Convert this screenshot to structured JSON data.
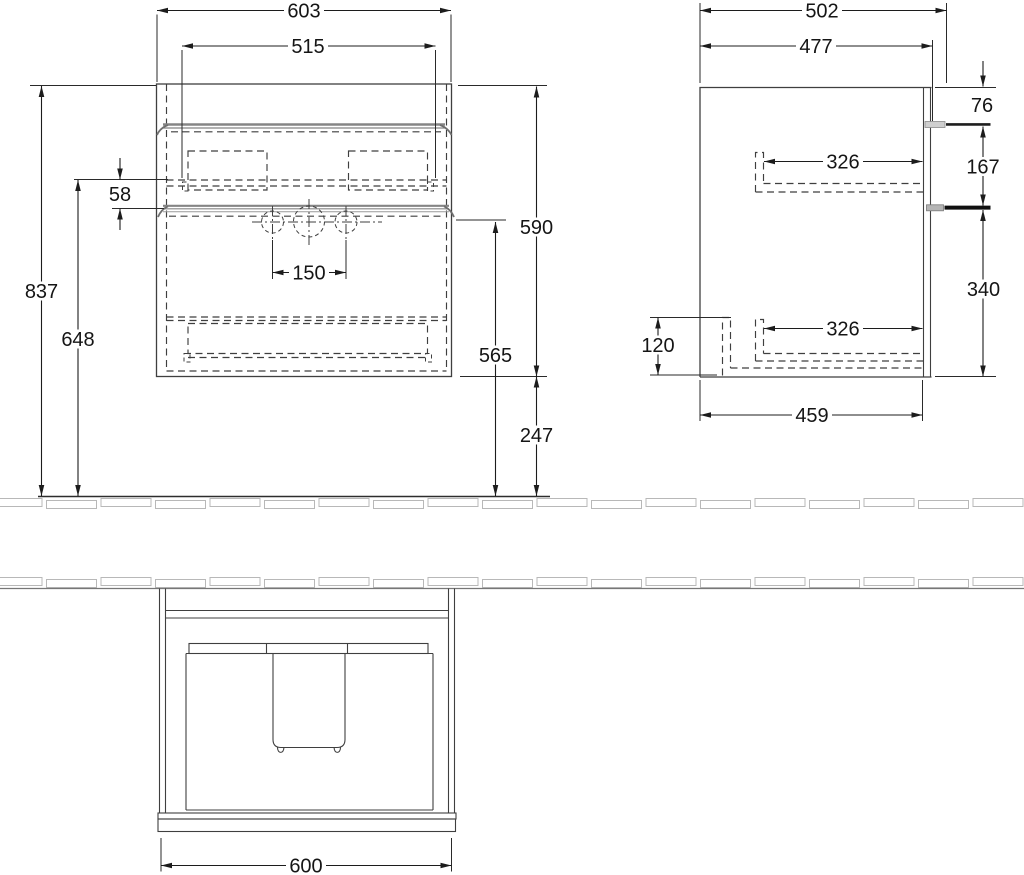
{
  "drawing": {
    "type": "technical-dimension-drawing",
    "subject": "wall-hung bathroom vanity unit: front elevation, side section and plan view",
    "units": "mm",
    "colors": {
      "background": "#ffffff",
      "structure_line": "#3f3f3f",
      "dimension_line": "#1c1c1c",
      "basin_gray": "#858585",
      "hatch_brick": "#b8b8b8",
      "bold_rail": "#101010"
    },
    "views": {
      "front_elevation": {
        "name": "front-elevation",
        "dimensions": [
          {
            "label": "603",
            "labelX": 304,
            "labelY": 10.5,
            "lines": [
              [
                157,
                10.5,
                451,
                10.5
              ]
            ],
            "arrows": [
              {
                "x": 157,
                "y": 10.5,
                "d": "l"
              },
              {
                "x": 451,
                "y": 10.5,
                "d": "r"
              }
            ],
            "exts": [
              [
                157,
                14.5,
                157,
                82
              ],
              [
                451,
                14.5,
                451,
                82
              ]
            ]
          },
          {
            "label": "515",
            "labelX": 308,
            "labelY": 46,
            "lines": [
              [
                182,
                46,
                435.5,
                46
              ]
            ],
            "arrows": [
              {
                "x": 182,
                "y": 46,
                "d": "l"
              },
              {
                "x": 435.5,
                "y": 46,
                "d": "r"
              }
            ],
            "exts": [
              [
                182,
                50,
                182,
                178
              ],
              [
                435.5,
                50,
                435.5,
                178
              ]
            ]
          },
          {
            "label": "58",
            "labelX": 120,
            "labelY": 194,
            "lines": [
              [
                120,
                158,
                120,
                179.5
              ],
              [
                120,
                230,
                120,
                208.5
              ]
            ],
            "arrows": [
              {
                "x": 120,
                "y": 179.5,
                "d": "d"
              },
              {
                "x": 120,
                "y": 208.5,
                "d": "u"
              }
            ],
            "exts": [
              [
                74,
                179.5,
                168,
                179.5
              ],
              [
                112,
                208.5,
                164,
                208.5
              ]
            ]
          },
          {
            "label": "837",
            "labelX": 41.5,
            "labelY": 291,
            "lines": [
              [
                41.5,
                86,
                41.5,
                496
              ]
            ],
            "arrows": [
              {
                "x": 41.5,
                "y": 86,
                "d": "u"
              },
              {
                "x": 41.5,
                "y": 496,
                "d": "d"
              }
            ],
            "exts": [
              [
                30,
                85.5,
                156,
                85.5
              ]
            ]
          },
          {
            "label": "648",
            "labelX": 78,
            "labelY": 339,
            "lines": [
              [
                78,
                180,
                78,
                496
              ]
            ],
            "arrows": [
              {
                "x": 78,
                "y": 180,
                "d": "u"
              },
              {
                "x": 78,
                "y": 496,
                "d": "d"
              }
            ],
            "exts": []
          },
          {
            "label": "150",
            "labelX": 309,
            "labelY": 272.5,
            "lines": [
              [
                272.5,
                272.5,
                346,
                272.5
              ]
            ],
            "arrows": [
              {
                "x": 272.5,
                "y": 272.5,
                "d": "l"
              },
              {
                "x": 346,
                "y": 272.5,
                "d": "r"
              }
            ],
            "exts": [
              [
                272.5,
                240,
                272.5,
                279
              ],
              [
                346,
                240,
                346,
                279
              ]
            ]
          },
          {
            "label": "590",
            "labelX": 536.5,
            "labelY": 227,
            "lines": [
              [
                536.5,
                86.5,
                536.5,
                376.5
              ]
            ],
            "arrows": [
              {
                "x": 536.5,
                "y": 86.5,
                "d": "u"
              },
              {
                "x": 536.5,
                "y": 376.5,
                "d": "d"
              }
            ],
            "exts": [
              [
                458,
                85.5,
                547,
                85.5
              ],
              [
                460,
                376.5,
                547,
                376.5
              ]
            ]
          },
          {
            "label": "565",
            "labelX": 495.5,
            "labelY": 355,
            "lines": [
              [
                495.5,
                222,
                495.5,
                496
              ]
            ],
            "arrows": [
              {
                "x": 495.5,
                "y": 222,
                "d": "u"
              },
              {
                "x": 495.5,
                "y": 496,
                "d": "d"
              }
            ],
            "exts": [
              [
                456,
                220,
                506,
                220
              ]
            ]
          },
          {
            "label": "247",
            "labelX": 536.5,
            "labelY": 435,
            "lines": [
              [
                536.5,
                376.5,
                536.5,
                496
              ]
            ],
            "arrows": [
              {
                "x": 536.5,
                "y": 376.5,
                "d": "u"
              },
              {
                "x": 536.5,
                "y": 496,
                "d": "d"
              }
            ],
            "exts": []
          }
        ]
      },
      "side_section": {
        "name": "side-section",
        "dimensions": [
          {
            "label": "502",
            "labelX": 822,
            "labelY": 10.5,
            "lines": [
              [
                700,
                10.5,
                946.5,
                10.5
              ]
            ],
            "arrows": [
              {
                "x": 700,
                "y": 10.5,
                "d": "l"
              },
              {
                "x": 946.5,
                "y": 10.5,
                "d": "r"
              }
            ],
            "exts": [
              [
                700,
                3,
                700,
                83
              ],
              [
                946.5,
                3,
                946.5,
                83
              ]
            ]
          },
          {
            "label": "477",
            "labelX": 816,
            "labelY": 46,
            "lines": [
              [
                700,
                46,
                932.5,
                46
              ]
            ],
            "arrows": [
              {
                "x": 700,
                "y": 46,
                "d": "l"
              },
              {
                "x": 932.5,
                "y": 46,
                "d": "r"
              }
            ],
            "exts": [
              [
                932.5,
                40,
                932.5,
                121
              ]
            ]
          },
          {
            "label": "76",
            "labelX": 982,
            "labelY": 105,
            "lines": [
              [
                983,
                61,
                983,
                86.5
              ]
            ],
            "arrows": [
              {
                "x": 983,
                "y": 86.5,
                "d": "d"
              }
            ],
            "exts": [
              [
                935,
                87.5,
                996,
                87.5
              ]
            ]
          },
          {
            "label": "167",
            "labelX": 983,
            "labelY": 166.5,
            "lines": [
              [
                983,
                126.5,
                983,
                205.5
              ]
            ],
            "arrows": [
              {
                "x": 983,
                "y": 126.5,
                "d": "u"
              },
              {
                "x": 983,
                "y": 205.5,
                "d": "d"
              }
            ],
            "exts": []
          },
          {
            "label": "340",
            "labelX": 983.5,
            "labelY": 289,
            "lines": [
              [
                983,
                210,
                983,
                376.5
              ]
            ],
            "arrows": [
              {
                "x": 983,
                "y": 210,
                "d": "u"
              },
              {
                "x": 983,
                "y": 376.5,
                "d": "d"
              }
            ],
            "exts": [
              [
                935,
                376.5,
                996,
                376.5
              ]
            ]
          },
          {
            "label": "326",
            "labelX": 843,
            "labelY": 161.5,
            "lines": [
              [
                764,
                161.5,
                922.5,
                161.5
              ]
            ],
            "arrows": [
              {
                "x": 764,
                "y": 161.5,
                "d": "l"
              },
              {
                "x": 922.5,
                "y": 161.5,
                "d": "r"
              }
            ],
            "exts": []
          },
          {
            "label": "326",
            "labelX": 843,
            "labelY": 328.5,
            "lines": [
              [
                764,
                328.5,
                922.5,
                328.5
              ]
            ],
            "arrows": [
              {
                "x": 764,
                "y": 328.5,
                "d": "l"
              },
              {
                "x": 922.5,
                "y": 328.5,
                "d": "r"
              }
            ],
            "exts": []
          },
          {
            "label": "120",
            "labelX": 658,
            "labelY": 345,
            "lines": [
              [
                658,
                317.5,
                658,
                375
              ]
            ],
            "arrows": [
              {
                "x": 658,
                "y": 317.5,
                "d": "u"
              },
              {
                "x": 658,
                "y": 375,
                "d": "d"
              }
            ],
            "exts": [
              [
                650,
                317.5,
                731,
                317.5
              ],
              [
                650,
                375,
                717,
                375
              ]
            ]
          },
          {
            "label": "459",
            "labelX": 812,
            "labelY": 415,
            "lines": [
              [
                700,
                415,
                922.5,
                415
              ]
            ],
            "arrows": [
              {
                "x": 700,
                "y": 415,
                "d": "l"
              },
              {
                "x": 922.5,
                "y": 415,
                "d": "r"
              }
            ],
            "exts": [
              [
                700,
                380,
                700,
                421
              ],
              [
                922.5,
                380,
                922.5,
                421
              ]
            ]
          }
        ]
      },
      "plan_view": {
        "name": "plan-view",
        "dimensions": [
          {
            "label": "600",
            "labelX": 306,
            "labelY": 865.5,
            "lines": [
              [
                161,
                865.5,
                451.5,
                865.5
              ]
            ],
            "arrows": [
              {
                "x": 161,
                "y": 865.5,
                "d": "l"
              },
              {
                "x": 451.5,
                "y": 865.5,
                "d": "r"
              }
            ],
            "exts": [
              [
                161,
                838,
                161,
                871.5
              ],
              [
                451.5,
                838,
                451.5,
                871.5
              ]
            ]
          }
        ]
      }
    },
    "hatch_bands": [
      {
        "name": "floor-band",
        "y": 498.5,
        "brickW": 50,
        "brickH": 8,
        "gap": 4.5,
        "stagger": 2
      },
      {
        "name": "wall-band",
        "y": 577.5,
        "brickW": 50,
        "brickH": 8,
        "gap": 4.5,
        "stagger": 2
      }
    ]
  }
}
